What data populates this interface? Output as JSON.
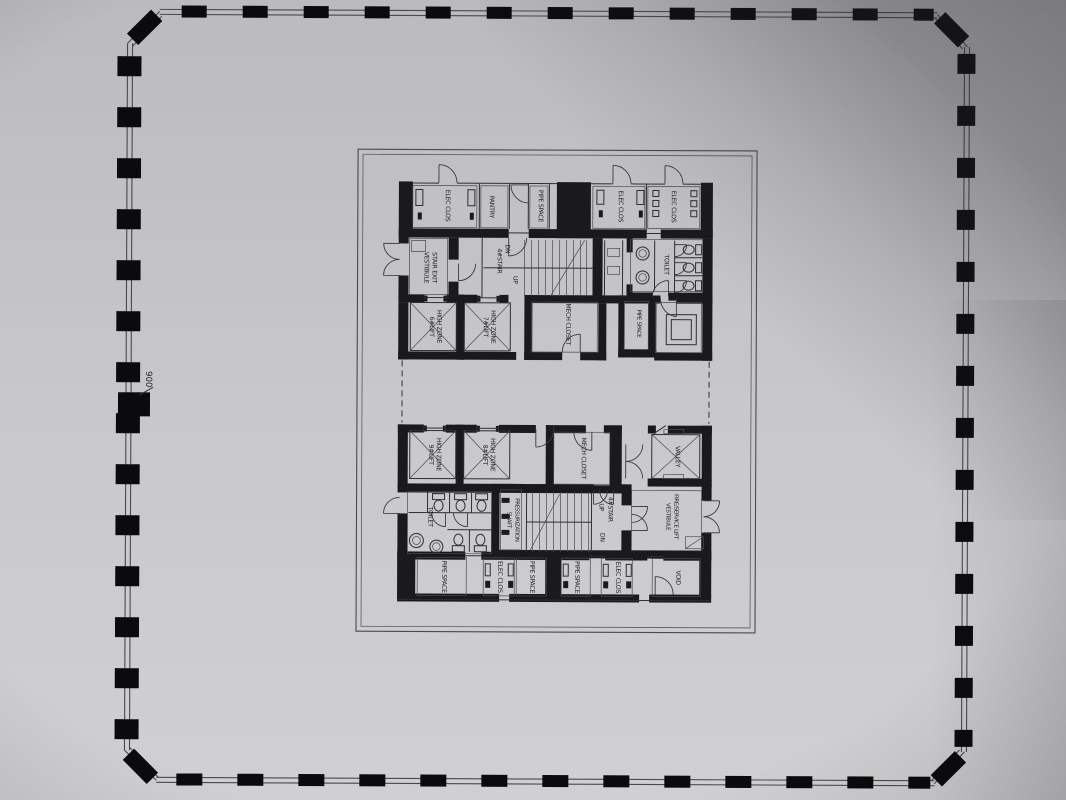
{
  "photo": {
    "paper_top": "#bbbbbd",
    "paper_bottom": "#d0d0d2",
    "ink": "#232328",
    "wall": "#1a1a1e",
    "tick": "#0b0b0d",
    "shadow": "#28282c"
  },
  "plan": {
    "dimension": "900",
    "labels": {
      "elec_clos_tl": "ELEC CLOS",
      "pantry": "PANTRY",
      "pipe_space_top": "PIPE SPACE",
      "elec_clos_tr1": "ELEC CLOS",
      "elec_clos_tr2": "ELEC CLOS",
      "vestibule_1": "STAIR EXIT",
      "vestibule_2": "VESTIBULE",
      "stair_u_dn": "DN",
      "stair_u": "4#STAIR",
      "stair_u_up": "UP",
      "toilet_u": "TOILET",
      "lift6_1": "HIGH ZONE",
      "lift6_2": "6#LIFT",
      "lift7_1": "HIGH ZONE",
      "lift7_2": "7#LIFT",
      "mech_u": "MECH CLOSET",
      "pipe_mid": "PIPE SPACE",
      "lift9_1": "HIGH ZONE",
      "lift9_2": "9#LIFT",
      "lift8_1": "HIGH ZONE",
      "lift8_2": "8#LIFT",
      "mech_l": "MECH CLOSET",
      "valley": "VALLEY",
      "toilet_l": "TOILET",
      "press_1": "PRESSURIZATION",
      "press_2": "SHAFT",
      "stair_l_up": "UP",
      "stair_l": "4#STAIR",
      "stair_l_dn": "DN",
      "fire_1": "FIRE/SERVICE LIFT",
      "fire_2": "VESTIBULE",
      "pipe_b1": "PIPE SPACE",
      "elec_b1": "ELEC CLOS",
      "pipe_b2": "PIPE SPACE",
      "pipe_b3": "PIPE SPACE",
      "elec_b2": "ELEC CLOS",
      "void": "VOID"
    }
  }
}
